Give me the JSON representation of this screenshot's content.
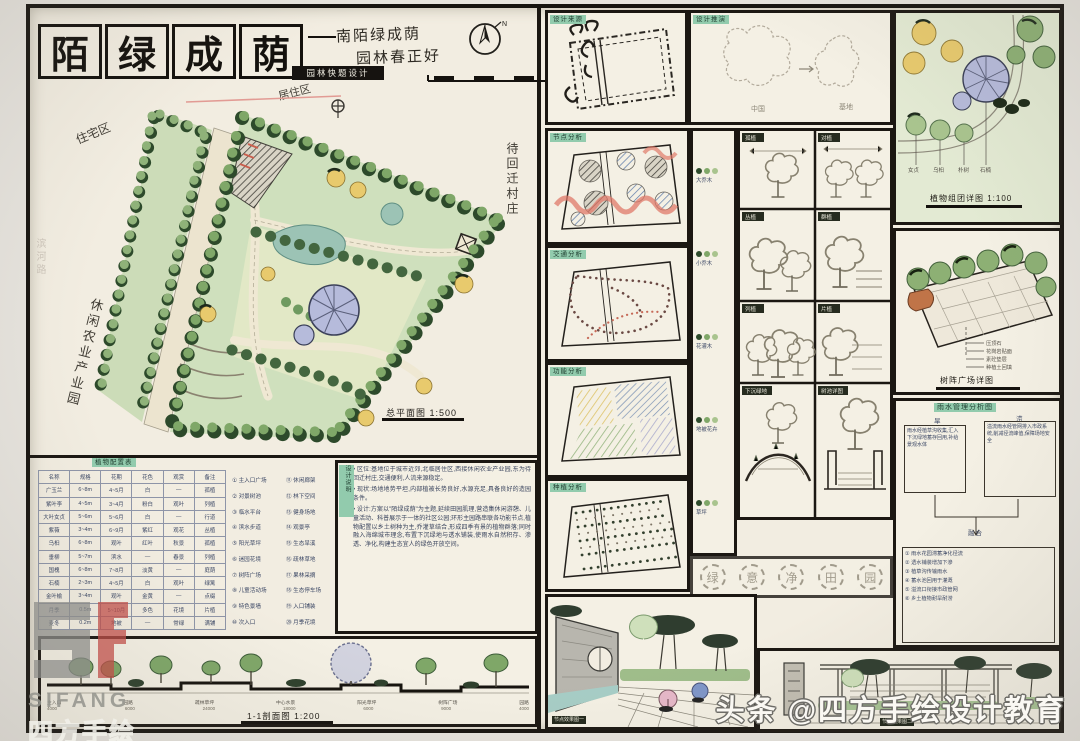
{
  "colors": {
    "paper": "#f2ede1",
    "ink": "#171410",
    "table_ink": "#3b4765",
    "tag_green": "#92cbad",
    "tree_green": "#7fa768",
    "tree_dark": "#2d4a2b",
    "lawn": "#dfe7c5",
    "water": "#9cc3b5",
    "accent_yellow": "#e8ca6d",
    "accent_purple": "#b6bbdb",
    "accent_red": "#d9705c",
    "pencil": "#8b8578"
  },
  "header": {
    "title_chars": [
      "陌",
      "绿",
      "成",
      "荫"
    ],
    "subtitle1": "南陌绿成荫",
    "subtitle2": "园林春正好",
    "stamp": "园林快题设计",
    "annotation": "居住区",
    "north": "N"
  },
  "plan": {
    "label_top": "住宅区",
    "label_left": "休闲农业产业园",
    "label_right": "待回迁村庄",
    "label_margin": "滨河路",
    "title": "总平面图 1:500"
  },
  "plant_table": {
    "title": "植物配置表",
    "headers": [
      "名称",
      "规格",
      "花期",
      "花色",
      "观赏",
      "备注"
    ],
    "rows": [
      [
        "广玉兰",
        "6~8m",
        "4~5月",
        "白",
        "—",
        "孤植"
      ],
      [
        "紫叶李",
        "4~5m",
        "3~4月",
        "粉白",
        "观叶",
        "列植"
      ],
      [
        "大叶女贞",
        "5~6m",
        "5~6月",
        "白",
        "—",
        "行道"
      ],
      [
        "紫薇",
        "3~4m",
        "6~9月",
        "紫红",
        "观花",
        "丛植"
      ],
      [
        "乌桕",
        "6~8m",
        "观叶",
        "红叶",
        "秋景",
        "孤植"
      ],
      [
        "垂柳",
        "5~7m",
        "滨水",
        "—",
        "春景",
        "列植"
      ],
      [
        "国槐",
        "6~8m",
        "7~8月",
        "淡黄",
        "—",
        "庭荫"
      ],
      [
        "石楠",
        "2~3m",
        "4~5月",
        "白",
        "观叶",
        "绿篱"
      ],
      [
        "金叶榆",
        "3~4m",
        "观叶",
        "金黄",
        "—",
        "点缀"
      ],
      [
        "月季",
        "0.5m",
        "5~10月",
        "多色",
        "花境",
        "片植"
      ],
      [
        "麦冬",
        "0.2m",
        "地被",
        "—",
        "常绿",
        "满铺"
      ]
    ]
  },
  "legend": {
    "left": [
      "① 主入口广场",
      "② 对景树池",
      "③ 临水平台",
      "④ 滨水步道",
      "⑤ 阳光草坪",
      "⑥ 迷园花境",
      "⑦ 树阵广场",
      "⑧ 儿童活动场",
      "⑨ 特色景墙",
      "⑩ 次入口"
    ],
    "right": [
      "⑪ 休闲廊架",
      "⑫ 林下空间",
      "⑬ 健身场地",
      "⑭ 观景亭",
      "⑮ 生态旱溪",
      "⑯ 疏林草地",
      "⑰ 果林采摘",
      "⑱ 生态停车场",
      "⑲ 入口铺装",
      "⑳ 月季花境"
    ]
  },
  "notes": {
    "tag": "设计说明",
    "paragraphs": [
      "• 区位:基地位于城市近郊,北临居住区,西接休闲农业产业园,东为待回迁村庄,交通便利,人流来源稳定。",
      "• 现状:场地地势平坦,内部植被长势良好,水源充足,具备良好的造园条件。",
      "• 设计:方案以\"陌绿成荫\"为主题,延续田园肌理,营造集休闲游憩、儿童活动、科普展示于一体的社区公园;环形主园路串联各功能节点,植物配置以乡土树种为主,乔灌草结合,形成四季有景的植物群落;同时融入海绵城市理念,布置下沉绿地与透水铺装,使雨水自然积存、渗透、净化,构建生态宜人的绿色开放空间。"
    ]
  },
  "section": {
    "title": "1-1剖面图 1:200",
    "labels": [
      "主入口",
      "园路",
      "疏林草坪",
      "中心水景",
      "阳光草坪",
      "树阵广场",
      "园路"
    ],
    "dims": [
      "4000",
      "6000",
      "24000",
      "18000",
      "6000",
      "9000",
      "4000"
    ]
  },
  "source_panel": {
    "tag": "设计来源"
  },
  "evolution_panel": {
    "tag": "设计推演",
    "label_a": "中国",
    "label_b": "基地"
  },
  "detail_plan": {
    "title": "植物组团详图 1:100",
    "labels": [
      "女贞",
      "乌桕",
      "朴树",
      "石楠"
    ]
  },
  "analysis": {
    "tags": [
      "节点分析",
      "交通分析",
      "功能分析",
      "种植分析"
    ]
  },
  "strip_legend": {
    "groups": [
      "大乔木",
      "小乔木",
      "花灌木",
      "地被花卉",
      "草坪"
    ]
  },
  "tree_panels": {
    "labels": [
      "孤植",
      "对植",
      "丛植",
      "群植",
      "列植",
      "片植",
      "下沉绿地",
      "树池详图"
    ]
  },
  "axon": {
    "title": "树阵广场详图",
    "annotations": [
      "压顶石",
      "花岗岩贴面",
      "素砼垫层",
      "种植土回填"
    ]
  },
  "flow": {
    "title": "雨水管理分析图",
    "label_a": "旱",
    "label_b": "涝",
    "box_a": "雨水经植草沟收集,汇入下沉绿地蓄存回用,补给景观水体",
    "box_b": "溢流雨水经管网排入市政系统,削减径流峰值,保障场地安全",
    "merge": "融合",
    "notes": [
      "① 雨水花园滞蓄净化径流",
      "② 透水铺装增加下渗",
      "③ 植草沟传输雨水",
      "④ 蓄水池回用于灌溉",
      "⑤ 溢流口衔接市政管网",
      "⑥ 乡土植物耐旱耐涝"
    ]
  },
  "circled": {
    "chars": [
      "绿",
      "意",
      "净",
      "田",
      "园"
    ]
  },
  "perspectives": {
    "tag_left": "节点效果图一",
    "tag_right": "节点效果图二"
  },
  "watermark": {
    "logo": "SIFANG",
    "logo_cn": "四方手绘",
    "credit": "头条 @四方手绘设计教育"
  }
}
